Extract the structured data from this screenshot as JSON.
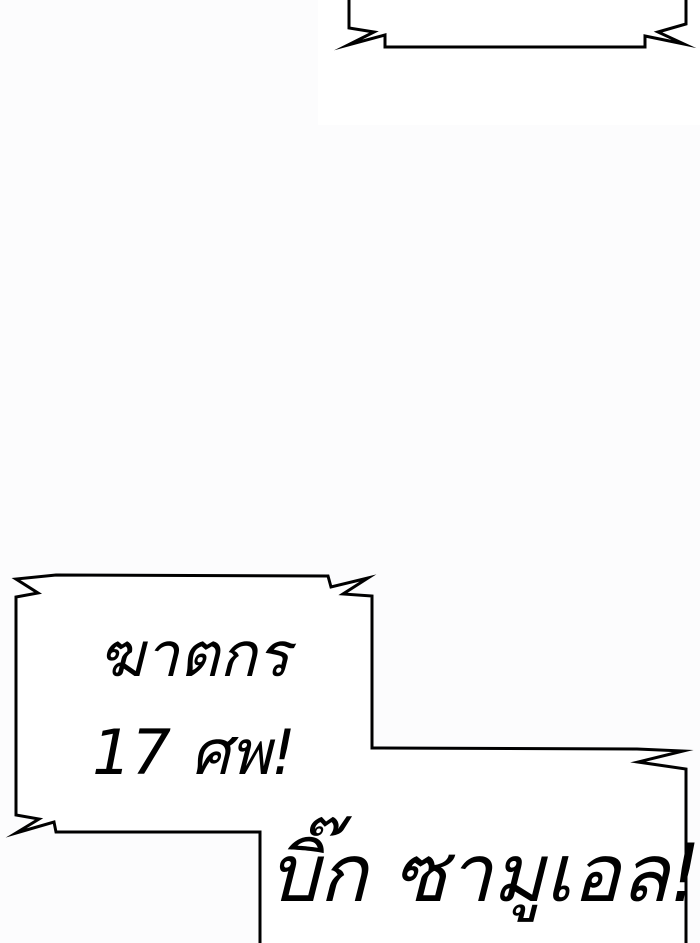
{
  "scene": {
    "background_color": "#fcfcfd",
    "panel_white": "#ffffff",
    "outline_color": "#000000",
    "bubble_fill": "#ffffff",
    "text_color": "#000000"
  },
  "speech": {
    "murder_lines": [
      "ฆาตกร",
      "17 ศพ!"
    ],
    "samuel_line": "บิ๊ก ซามูเอล!"
  }
}
